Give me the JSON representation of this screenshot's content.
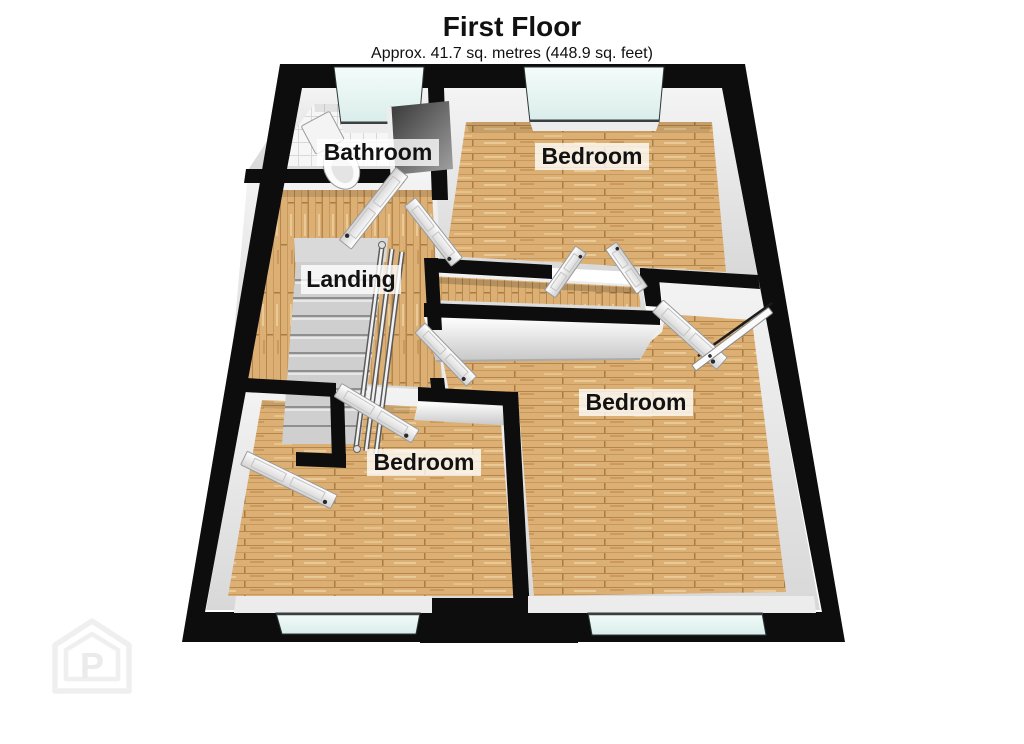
{
  "header": {
    "title": "First Floor",
    "subtitle": "Approx. 41.7 sq. metres (448.9 sq. feet)"
  },
  "rooms": [
    {
      "id": "bathroom",
      "label": "Bathroom"
    },
    {
      "id": "bedroom-top",
      "label": "Bedroom"
    },
    {
      "id": "landing",
      "label": "Landing"
    },
    {
      "id": "bedroom-right",
      "label": "Bedroom"
    },
    {
      "id": "bedroom-left",
      "label": "Bedroom"
    }
  ],
  "watermark": {
    "letter": "P"
  },
  "colors": {
    "wall": "#0d0d0d",
    "wood": "#dcb074",
    "wood_line": "#b5854a",
    "tile": "#f6f6f6",
    "glass": "#d9edea",
    "label_bg": "#ffffff"
  }
}
